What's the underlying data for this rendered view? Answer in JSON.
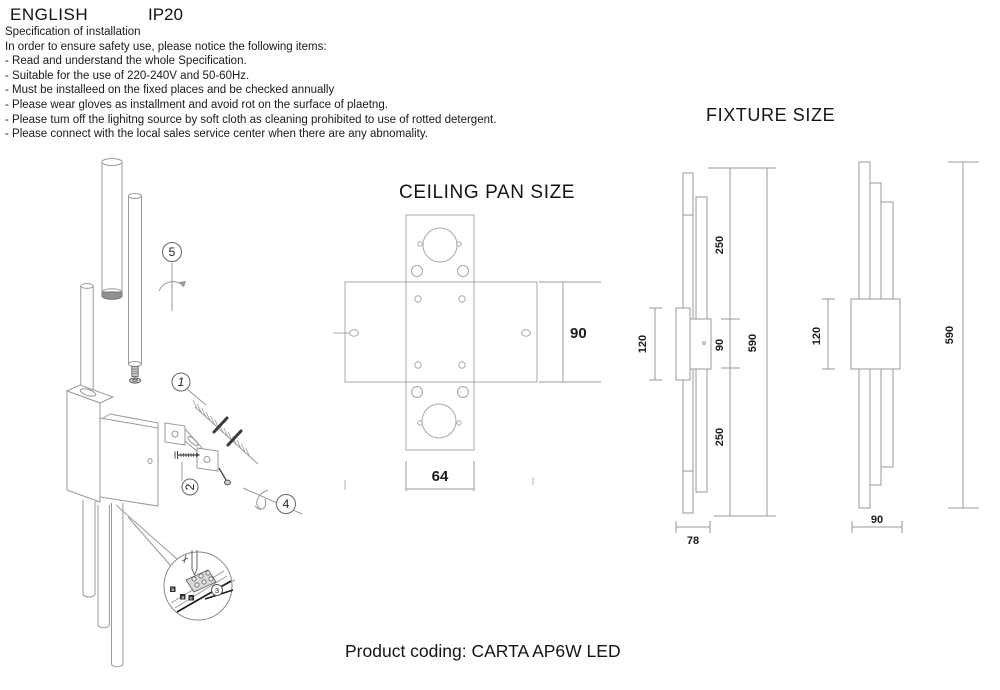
{
  "header": {
    "language": "ENGLISH",
    "ip_rating": "IP20"
  },
  "spec": {
    "title": "Specification of installation",
    "intro": "In order to ensure safety use, please notice the following items:",
    "items": [
      "- Read and understand the whole Specification.",
      "- Suitable for the use of 220-240V and 50-60Hz.",
      "- Must be installeed on the fixed places and be checked annually",
      "- Please wear gloves as installment and avoid rot on the surface of plaetng.",
      "- Please tum off the lighitng source by soft cloth as cleaning prohibited to use of rotted detergent.",
      "- Please connect with the local sales service center when there are any abnomality."
    ]
  },
  "installation_diagram": {
    "step_labels": {
      "step1": "1",
      "step2": "2",
      "step3": "3",
      "step4": "4",
      "step5": "5"
    },
    "wire_terminal_labels": {
      "left": "b",
      "middle": "a",
      "right": "c"
    }
  },
  "ceiling_pan": {
    "title": "CEILING PAN SIZE",
    "dimensions": {
      "height": "90",
      "width": "64"
    }
  },
  "fixture_size": {
    "title": "FIXTURE SIZE",
    "side_view": {
      "plate_height": "120",
      "upper_tube": "250",
      "center": "90",
      "total_height": "590",
      "lower_tube": "250",
      "depth": "78"
    },
    "front_view": {
      "plate_height": "120",
      "total_height": "590",
      "width": "90"
    }
  },
  "footer": {
    "product_coding": "Product coding: CARTA AP6W LED"
  },
  "colors": {
    "line": "#999999",
    "text": "#1a1a1a",
    "dark_part": "#3a3a3a"
  }
}
